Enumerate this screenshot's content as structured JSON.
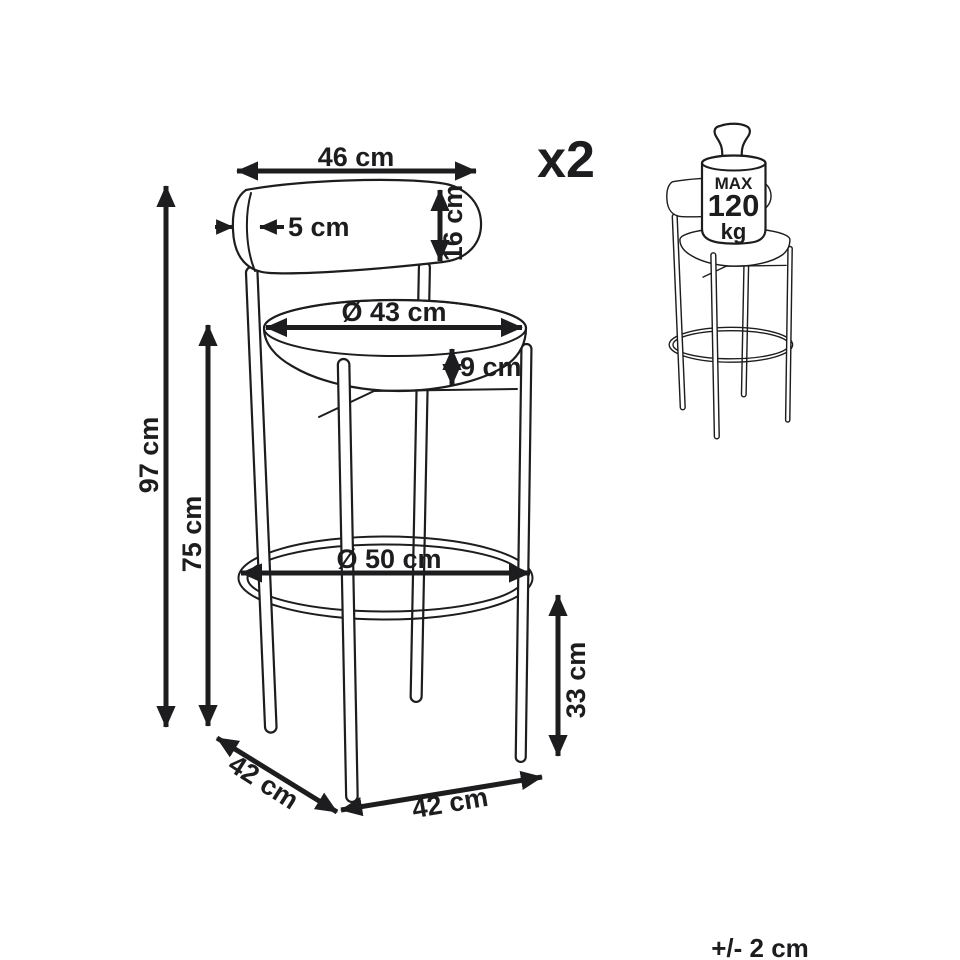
{
  "diagram": {
    "quantity": "x2",
    "tolerance": "+/- 2 cm",
    "weight_limit": {
      "label_max": "MAX",
      "value": "120",
      "unit": "kg"
    },
    "dimensions": {
      "backrest_width": "46 cm",
      "backrest_thickness": "5 cm",
      "backrest_height": "16 cm",
      "seat_diameter": "Ø 43 cm",
      "seat_thickness": "9 cm",
      "total_height": "97 cm",
      "height_to_seat": "75 cm",
      "footrest_ring_diameter": "Ø 50 cm",
      "footrest_height": "33 cm",
      "base_depth": "42 cm",
      "base_width": "42 cm"
    },
    "colors": {
      "ink": "#1d1d1f",
      "background": "#ffffff"
    }
  }
}
